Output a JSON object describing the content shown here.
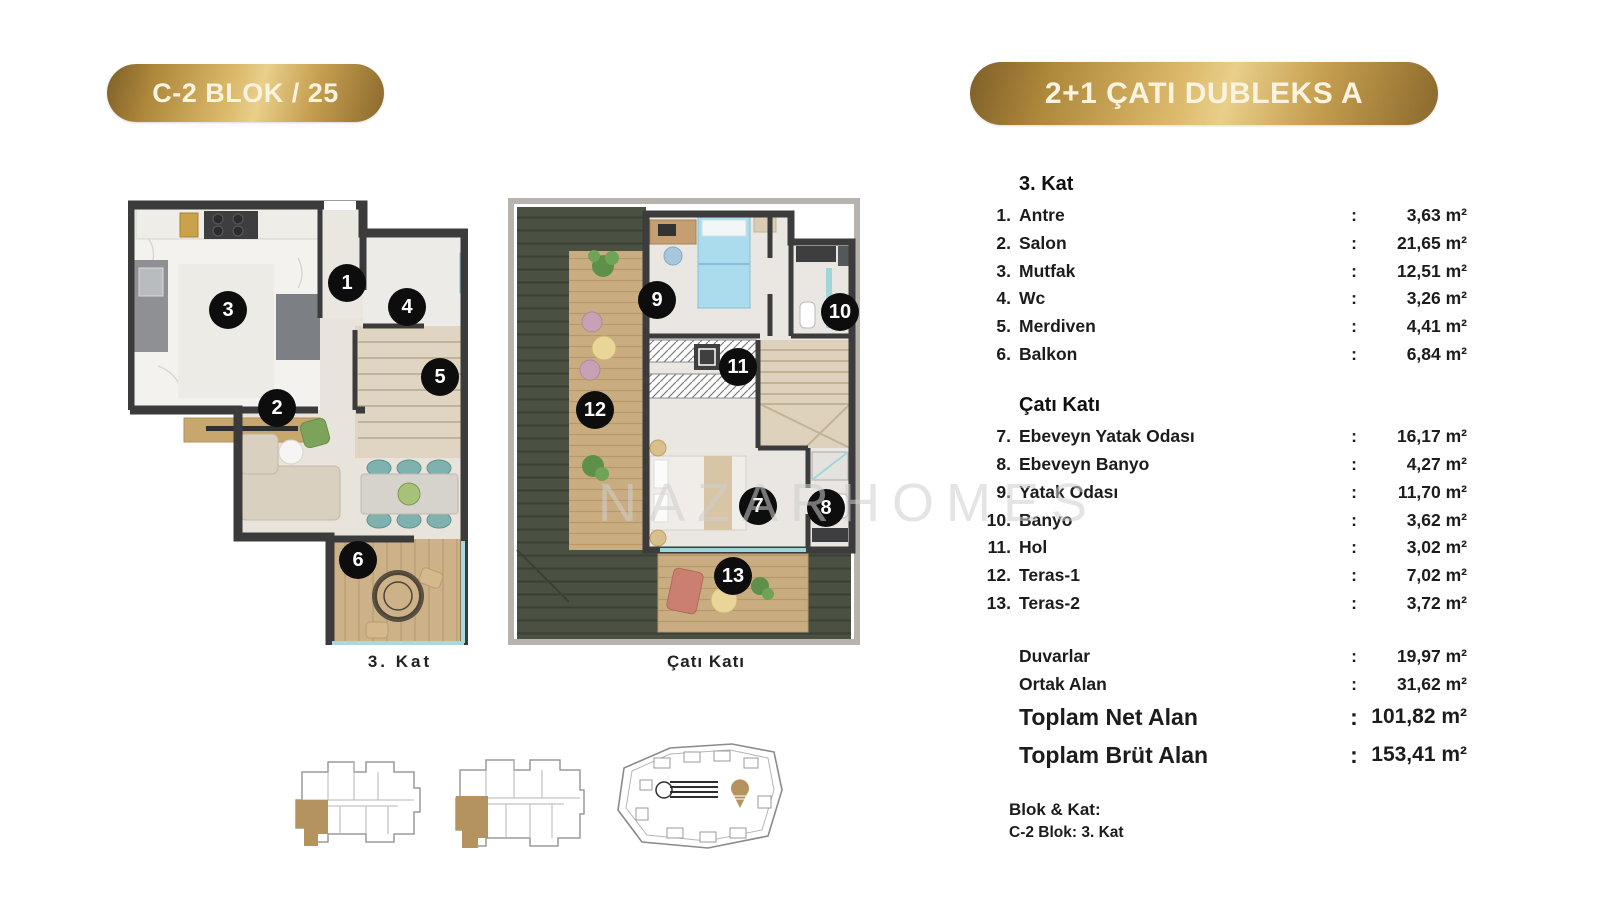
{
  "header": {
    "left_badge": "C-2 BLOK / 25",
    "right_badge": "2+1 ÇATI DUBLEKS A"
  },
  "watermark": "NAZARHOMES",
  "colors": {
    "gold": "#c9a55e",
    "wall": "#3c3c3c",
    "roof_green": "#4a5143",
    "key_highlight": "#b5935f"
  },
  "plans": [
    {
      "caption": "3. Kat",
      "markers": [
        {
          "n": "1",
          "x": 219,
          "y": 85
        },
        {
          "n": "2",
          "x": 149,
          "y": 210
        },
        {
          "n": "3",
          "x": 100,
          "y": 112
        },
        {
          "n": "4",
          "x": 279,
          "y": 109
        },
        {
          "n": "5",
          "x": 312,
          "y": 179
        },
        {
          "n": "6",
          "x": 230,
          "y": 362
        }
      ]
    },
    {
      "caption": "Çatı Katı",
      "markers": [
        {
          "n": "7",
          "x": 250,
          "y": 308
        },
        {
          "n": "8",
          "x": 318,
          "y": 310
        },
        {
          "n": "9",
          "x": 149,
          "y": 102
        },
        {
          "n": "10",
          "x": 332,
          "y": 114
        },
        {
          "n": "11",
          "x": 230,
          "y": 169
        },
        {
          "n": "12",
          "x": 87,
          "y": 212
        },
        {
          "n": "13",
          "x": 225,
          "y": 378
        }
      ]
    }
  ],
  "details": {
    "unit": "m²",
    "colon": ":",
    "sections": [
      {
        "title": "3. Kat",
        "rows": [
          {
            "num": "1.",
            "label": "Antre",
            "value": "3,63"
          },
          {
            "num": "2.",
            "label": "Salon",
            "value": "21,65"
          },
          {
            "num": "3.",
            "label": "Mutfak",
            "value": "12,51"
          },
          {
            "num": "4.",
            "label": "Wc",
            "value": "3,26"
          },
          {
            "num": "5.",
            "label": "Merdiven",
            "value": "4,41"
          },
          {
            "num": "6.",
            "label": "Balkon",
            "value": "6,84"
          }
        ]
      },
      {
        "title": "Çatı Katı",
        "rows": [
          {
            "num": "7.",
            "label": "Ebeveyn Yatak Odası",
            "value": "16,17"
          },
          {
            "num": "8.",
            "label": "Ebeveyn Banyo",
            "value": "4,27"
          },
          {
            "num": "9.",
            "label": "Yatak Odası",
            "value": "11,70"
          },
          {
            "num": "10.",
            "label": "Banyo",
            "value": "3,62"
          },
          {
            "num": "11.",
            "label": "Hol",
            "value": "3,02"
          },
          {
            "num": "12.",
            "label": "Teras-1",
            "value": "7,02"
          },
          {
            "num": "13.",
            "label": "Teras-2",
            "value": "3,72"
          }
        ]
      }
    ],
    "summary": [
      {
        "label": "Duvarlar",
        "value": "19,97",
        "size": "normal"
      },
      {
        "label": "Ortak Alan",
        "value": "31,62",
        "size": "normal"
      },
      {
        "label": "Toplam Net Alan",
        "value": "101,82",
        "size": "large"
      },
      {
        "label": "Toplam Brüt Alan",
        "value": "153,41",
        "size": "large"
      }
    ],
    "footer": {
      "title": "Blok & Kat:",
      "line": "C-2 Blok:  3. Kat"
    }
  }
}
